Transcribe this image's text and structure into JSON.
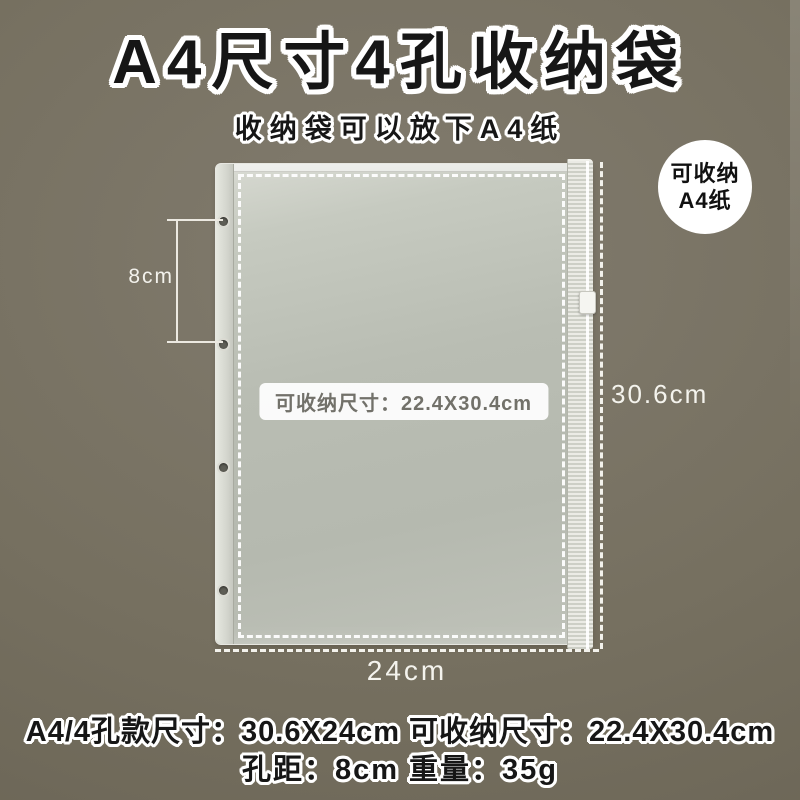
{
  "header": {
    "title": "A4尺寸4孔收纳袋",
    "subtitle": "收纳袋可以放下A4纸"
  },
  "badge": {
    "line1": "可收纳",
    "line2": "A4纸"
  },
  "bag": {
    "inner_size_label": "可收纳尺寸：22.4X30.4cm",
    "hole_count": 4
  },
  "measurements": {
    "hole_spacing_label": "8cm",
    "height_label": "30.6cm",
    "width_label": "24cm"
  },
  "specs": {
    "line1": "A4/4孔款尺寸：30.6X24cm 可收纳尺寸：22.4X30.4cm",
    "line2": "孔距：8cm 重量：35g"
  },
  "colors": {
    "background": "#746d60",
    "bag_body": "#b8bcb2",
    "outline_white": "#ffffff",
    "title_text": "#161616",
    "measure_text": "#f4f3ed",
    "inner_label_text": "#72716a",
    "badge_background": "#ffffff",
    "badge_text": "#111111"
  }
}
